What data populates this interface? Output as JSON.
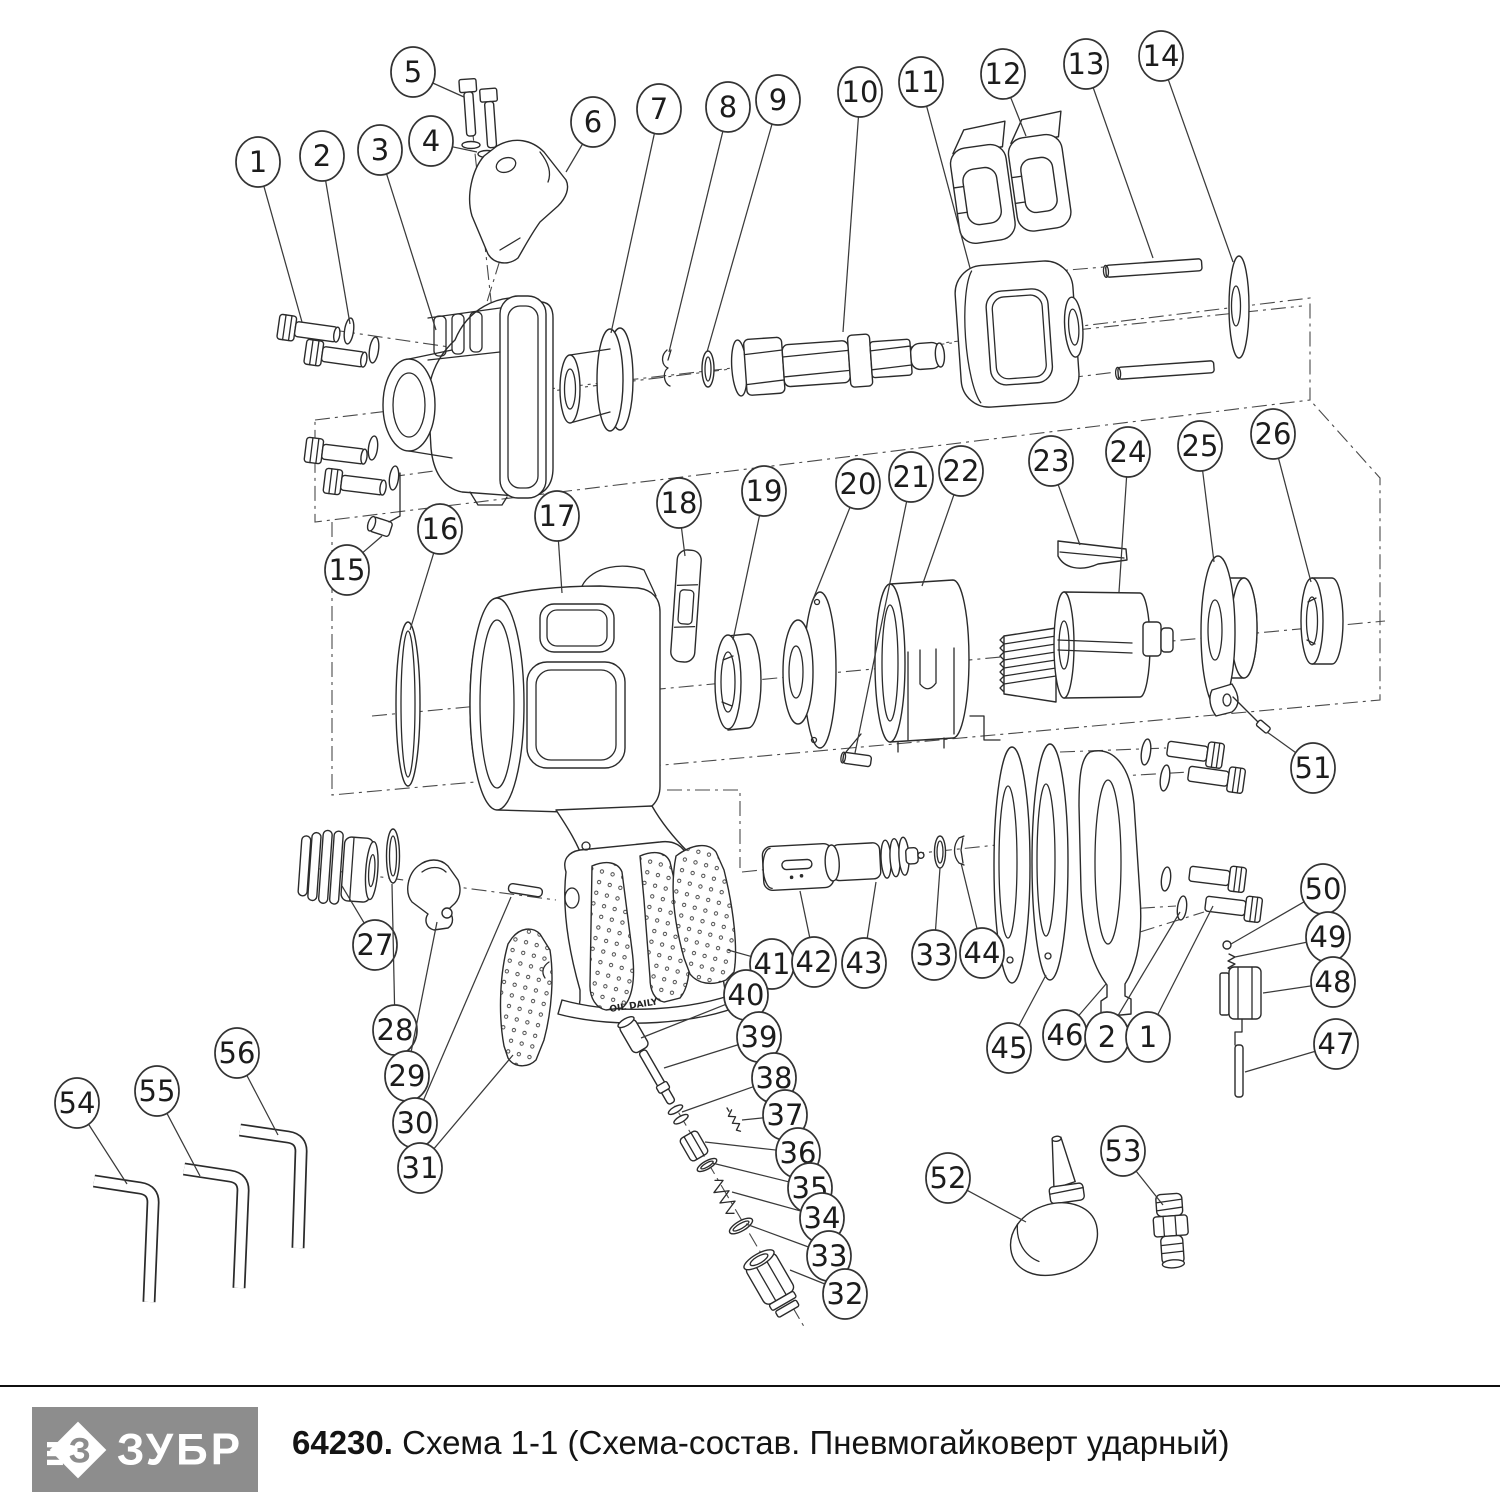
{
  "footer": {
    "brand": "ЗУБР",
    "code": "64230.",
    "title": "Схема 1-1 (Схема-состав. Пневмогайковерт ударный)"
  },
  "handle": {
    "marking": "OIL DAILY"
  },
  "drawing": {
    "line_color": "#2b2b2b",
    "callout_color": "#333333",
    "logo_bg": "#8d8d8d"
  },
  "callouts": [
    {
      "n": "1",
      "cx": 258,
      "cy": 162,
      "ex": 302,
      "ey": 322
    },
    {
      "n": "2",
      "cx": 322,
      "cy": 156,
      "ex": 350,
      "ey": 324
    },
    {
      "n": "3",
      "cx": 380,
      "cy": 150,
      "ex": 436,
      "ey": 330
    },
    {
      "n": "4",
      "cx": 431,
      "cy": 141,
      "ex": 477,
      "ey": 152
    },
    {
      "n": "5",
      "cx": 413,
      "cy": 72,
      "ex": 464,
      "ey": 97
    },
    {
      "n": "6",
      "cx": 593,
      "cy": 122,
      "ex": 566,
      "ey": 172
    },
    {
      "n": "7",
      "cx": 659,
      "cy": 109,
      "ex": 611,
      "ey": 333
    },
    {
      "n": "8",
      "cx": 728,
      "cy": 107,
      "ex": 669,
      "ey": 352
    },
    {
      "n": "9",
      "cx": 778,
      "cy": 100,
      "ex": 707,
      "ey": 352
    },
    {
      "n": "10",
      "cx": 860,
      "cy": 92,
      "ex": 843,
      "ey": 332
    },
    {
      "n": "11",
      "cx": 921,
      "cy": 82,
      "ex": 970,
      "ey": 268
    },
    {
      "n": "12",
      "cx": 1003,
      "cy": 74,
      "ex": 1026,
      "ey": 136
    },
    {
      "n": "13",
      "cx": 1086,
      "cy": 64,
      "ex": 1153,
      "ey": 258
    },
    {
      "n": "14",
      "cx": 1161,
      "cy": 56,
      "ex": 1233,
      "ey": 262
    },
    {
      "n": "15",
      "cx": 347,
      "cy": 570,
      "ex": 382,
      "ey": 536
    },
    {
      "n": "16",
      "cx": 440,
      "cy": 529,
      "ex": 410,
      "ey": 630
    },
    {
      "n": "17",
      "cx": 557,
      "cy": 516,
      "ex": 562,
      "ey": 593
    },
    {
      "n": "18",
      "cx": 679,
      "cy": 503,
      "ex": 685,
      "ey": 556
    },
    {
      "n": "19",
      "cx": 764,
      "cy": 491,
      "ex": 733,
      "ey": 640
    },
    {
      "n": "20",
      "cx": 858,
      "cy": 484,
      "ex": 812,
      "ey": 602
    },
    {
      "n": "21",
      "cx": 911,
      "cy": 477,
      "ex": 855,
      "ey": 753
    },
    {
      "n": "22",
      "cx": 961,
      "cy": 471,
      "ex": 922,
      "ey": 586
    },
    {
      "n": "23",
      "cx": 1051,
      "cy": 461,
      "ex": 1080,
      "ey": 545
    },
    {
      "n": "24",
      "cx": 1128,
      "cy": 452,
      "ex": 1119,
      "ey": 592
    },
    {
      "n": "25",
      "cx": 1200,
      "cy": 446,
      "ex": 1214,
      "ey": 562
    },
    {
      "n": "26",
      "cx": 1273,
      "cy": 434,
      "ex": 1311,
      "ey": 582
    },
    {
      "n": "51",
      "cx": 1313,
      "cy": 768,
      "ex": 1267,
      "ey": 732
    },
    {
      "n": "27",
      "cx": 375,
      "cy": 945,
      "ex": 342,
      "ey": 886
    },
    {
      "n": "28",
      "cx": 395,
      "cy": 1030,
      "ex": 392,
      "ey": 884
    },
    {
      "n": "29",
      "cx": 407,
      "cy": 1076,
      "ex": 437,
      "ey": 922
    },
    {
      "n": "30",
      "cx": 415,
      "cy": 1123,
      "ex": 511,
      "ey": 897
    },
    {
      "n": "31",
      "cx": 420,
      "cy": 1168,
      "ex": 513,
      "ey": 1055
    },
    {
      "n": "41",
      "cx": 772,
      "cy": 964,
      "ex": 728,
      "ey": 950
    },
    {
      "n": "42",
      "cx": 814,
      "cy": 962,
      "ex": 800,
      "ey": 891
    },
    {
      "n": "43",
      "cx": 864,
      "cy": 963,
      "ex": 876,
      "ey": 882
    },
    {
      "n": "33",
      "cx": 934,
      "cy": 955,
      "ex": 940,
      "ey": 868
    },
    {
      "n": "44",
      "cx": 982,
      "cy": 953,
      "ex": 961,
      "ey": 863
    },
    {
      "n": "40",
      "cx": 746,
      "cy": 995,
      "ex": 641,
      "ey": 1038
    },
    {
      "n": "39",
      "cx": 759,
      "cy": 1037,
      "ex": 664,
      "ey": 1068
    },
    {
      "n": "38",
      "cx": 774,
      "cy": 1078,
      "ex": 682,
      "ey": 1112
    },
    {
      "n": "37",
      "cx": 785,
      "cy": 1115,
      "ex": 742,
      "ey": 1120
    },
    {
      "n": "36",
      "cx": 798,
      "cy": 1153,
      "ex": 705,
      "ey": 1142
    },
    {
      "n": "35",
      "cx": 810,
      "cy": 1188,
      "ex": 712,
      "ey": 1163
    },
    {
      "n": "34",
      "cx": 822,
      "cy": 1218,
      "ex": 732,
      "ey": 1192
    },
    {
      "n": "33",
      "cx": 829,
      "cy": 1256,
      "ex": 746,
      "ey": 1224
    },
    {
      "n": "32",
      "cx": 845,
      "cy": 1294,
      "ex": 790,
      "ey": 1270
    },
    {
      "n": "45",
      "cx": 1009,
      "cy": 1048,
      "ex": 1046,
      "ey": 975
    },
    {
      "n": "46",
      "cx": 1065,
      "cy": 1035,
      "ex": 1106,
      "ey": 984
    },
    {
      "n": "2",
      "cx": 1107,
      "cy": 1037,
      "ex": 1180,
      "ey": 912
    },
    {
      "n": "1",
      "cx": 1148,
      "cy": 1037,
      "ex": 1213,
      "ey": 906
    },
    {
      "n": "50",
      "cx": 1323,
      "cy": 889,
      "ex": 1231,
      "ey": 944
    },
    {
      "n": "49",
      "cx": 1328,
      "cy": 937,
      "ex": 1235,
      "ey": 957
    },
    {
      "n": "48",
      "cx": 1333,
      "cy": 982,
      "ex": 1263,
      "ey": 993
    },
    {
      "n": "47",
      "cx": 1336,
      "cy": 1044,
      "ex": 1245,
      "ey": 1072
    },
    {
      "n": "52",
      "cx": 948,
      "cy": 1178,
      "ex": 1026,
      "ey": 1222
    },
    {
      "n": "53",
      "cx": 1123,
      "cy": 1151,
      "ex": 1163,
      "ey": 1205
    },
    {
      "n": "54",
      "cx": 77,
      "cy": 1103,
      "ex": 127,
      "ey": 1184
    },
    {
      "n": "55",
      "cx": 157,
      "cy": 1091,
      "ex": 200,
      "ey": 1176
    },
    {
      "n": "56",
      "cx": 237,
      "cy": 1053,
      "ex": 278,
      "ey": 1135
    }
  ]
}
